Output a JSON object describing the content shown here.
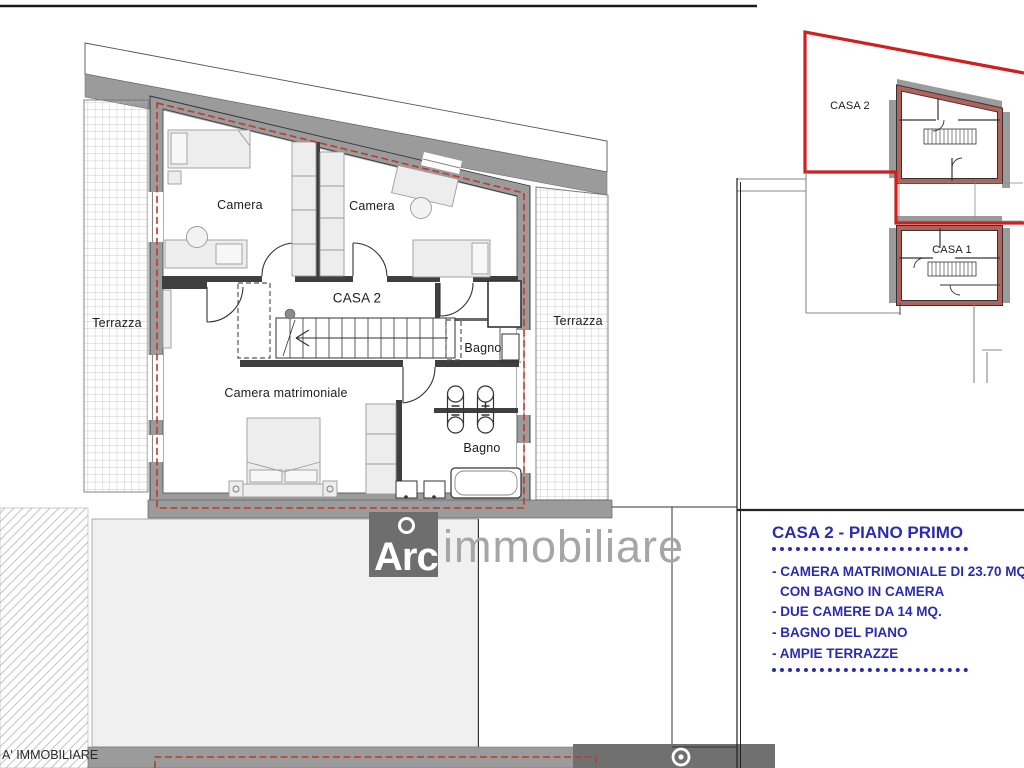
{
  "plan_labels": {
    "camera_left": "Camera",
    "camera_right": "Camera",
    "unit": "CASA 2",
    "bagno_upper": "Bagno",
    "bagno_lower": "Bagno",
    "camera_matrimoniale": "Camera matrimoniale",
    "terrazza_left": "Terrazza",
    "terrazza_right": "Terrazza"
  },
  "site_map": {
    "casa2": "CASA 2",
    "casa1": "CASA 1"
  },
  "info_panel": {
    "title": "CASA 2 - PIANO PRIMO",
    "features": [
      "- CAMERA MATRIMONIALE DI 23.70 MQ.",
      "CON BAGNO IN CAMERA",
      "- DUE CAMERE DA 14 MQ.",
      "- BAGNO DEL PIANO",
      "- AMPIE TERRAZZE"
    ]
  },
  "watermark": {
    "logo": "Arc",
    "name": "immobiliare"
  },
  "footer_text": "A' IMMOBILIARE",
  "colors": {
    "accent_blue": "#2b2bb2",
    "boundary_red": "#d01f1f",
    "dashed_red": "#c0392b",
    "wall_gray": "#9b9b9b"
  }
}
